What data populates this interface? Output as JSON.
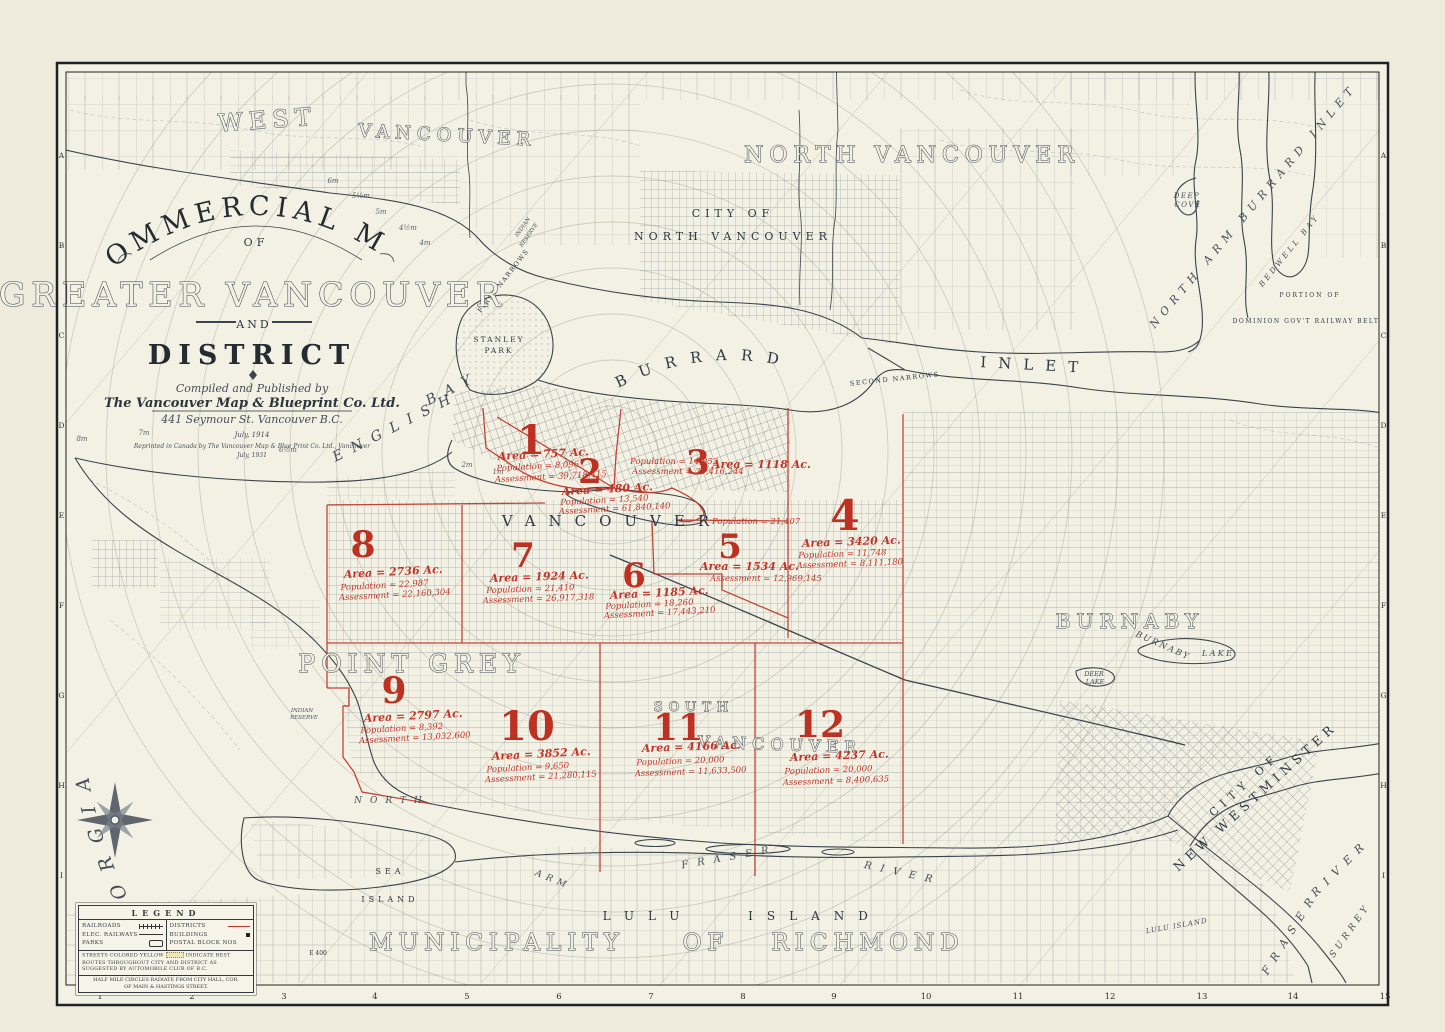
{
  "page": {
    "year": "Year 1913"
  },
  "cartouche": {
    "arc": "COMMERCIAL MAP",
    "of": "OF",
    "main": "GREATER VANCOUVER",
    "and": "AND",
    "district": "DISTRICT",
    "compiled": "Compiled and Published by",
    "publisher": "The Vancouver Map & Blueprint Co. Ltd.",
    "address": "441 Seymour St. Vancouver B.C.",
    "date": "July, 1914",
    "reprint": "Reprinted in Canada by The Vancouver Map & Blue Print Co. Ltd., Vancouver",
    "date2": "July, 1931"
  },
  "labels": {
    "west": "WEST",
    "west_van": "VANCOUVER",
    "north_vancouver": "NORTH  VANCOUVER",
    "city_of": "CITY OF",
    "city_of_nv": "NORTH VANCOUVER",
    "burrard": "BURRARD",
    "inlet": "INLET",
    "first_narrows": "FIRST NARROWS",
    "second_narrows": "SECOND NARROWS",
    "stanley": "STANLEY",
    "park": "PARK",
    "english": "ENGLISH",
    "bay": "BAY",
    "vancouver": "VANCOUVER",
    "point_grey": "POINT GREY",
    "south": "SOUTH",
    "south_van": "VANCOUVER",
    "burnaby": "BURNABY",
    "burnaby_lk1": "BURNABY",
    "burnaby_lk2": "LAKE",
    "deer1": "DEER",
    "deer2": "LAKE",
    "gulf": "GULF OF GEORGIA",
    "north": "NORTH",
    "arm": "ARM",
    "fraser_n": "FRASER",
    "river_n": "RIVER",
    "sea": "SEA",
    "island_s": "ISLAND",
    "lulu": "LULU",
    "island_l": "ISLAND",
    "municipality": "MUNICIPALITY",
    "of": "OF",
    "richmond": "RICHMOND",
    "city_of2": "CITY OF",
    "new_west": "NEW WESTMINSTER",
    "fraser_m": "FRASER",
    "river_m": "RIVER",
    "surrey": "SURREY",
    "nabi": "NORTH ARM BURRARD INLET",
    "deep": "DEEP",
    "cove": "COVE",
    "bedwell": "BEDWELL BAY",
    "portion": "PORTION OF",
    "dominion": "DOMINION GOV'T RAILWAY BELT",
    "lulu_small": "LULU ISLAND",
    "indian1": "INDIAN",
    "reserve1": "RESERVE",
    "e400": "E 400"
  },
  "depths": [
    "6m",
    "5½m",
    "5m",
    "4½m",
    "4m",
    "8m",
    "7m",
    "6½m",
    "2m",
    "1m"
  ],
  "districts": [
    {
      "no": "1",
      "area": "Area = 757 Ac.",
      "pop": "Population = 8,096",
      "asm": "Assessment = 39,718,415"
    },
    {
      "no": "2",
      "area": "Area = 480 Ac.",
      "pop": "Population = 13,540",
      "asm": "Assessment = 61,840,140"
    },
    {
      "no": "3",
      "area": "Area = 1118 Ac.",
      "pop": "Population = 14,853",
      "asm": "Assessment = 39,416,244"
    },
    {
      "no": "4",
      "area": "Area = 3420 Ac.",
      "pop": "Population = 11,748",
      "asm": "Assessment = 8,111,180"
    },
    {
      "no": "5",
      "area": "Area = 1534 Ac.",
      "pop": "Population = 21,407",
      "asm": "Assessment = 12,969,145"
    },
    {
      "no": "6",
      "area": "Area = 1185 Ac.",
      "pop": "Population = 18,260",
      "asm": "Assessment = 17,443,210"
    },
    {
      "no": "7",
      "area": "Area = 1924 Ac.",
      "pop": "Population = 21,410",
      "asm": "Assessment = 26,917,318"
    },
    {
      "no": "8",
      "area": "Area = 2736 Ac.",
      "pop": "Population = 22,987",
      "asm": "Assessment = 22,160,304"
    },
    {
      "no": "9",
      "area": "Area = 2797 Ac.",
      "pop": "Population = 8,392",
      "asm": "Assessment = 13,032,600"
    },
    {
      "no": "10",
      "area": "Area = 3852 Ac.",
      "pop": "Population = 9,650",
      "asm": "Assessment = 21,280,115"
    },
    {
      "no": "11",
      "area": "Area = 4166 Ac.",
      "pop": "Population = 20,000",
      "asm": "Assessment = 11,633,500"
    },
    {
      "no": "12",
      "area": "Area = 4237 Ac.",
      "pop": "Population = 20,000",
      "asm": "Assessment = 8,400,635"
    }
  ],
  "legend": {
    "title": "LEGEND",
    "left": [
      "RAILROADS",
      "ELEC. RAILWAYS",
      "PARKS"
    ],
    "right": [
      "DISTRICTS",
      "BUILDINGS",
      "POSTAL BLOCK NOS"
    ],
    "note1a": "STREETS COLORED YELLOW",
    "note1b": "INDICATE BEST ROUTES THROUGHOUT CITY AND DISTRICT AS SUGGESTED BY AUTOMOBILE CLUB OF B.C.",
    "note2": "HALF MILE CIRCLES RADIATE FROM CITY HALL, COR. OF MAIN & HASTINGS STREET."
  },
  "border": {
    "letters": [
      "A",
      "B",
      "C",
      "D",
      "E",
      "F",
      "G",
      "H",
      "I"
    ],
    "numbers": [
      "1",
      "2",
      "3",
      "4",
      "5",
      "6",
      "7",
      "8",
      "9",
      "10",
      "11",
      "12",
      "13",
      "14",
      "15"
    ]
  },
  "colors": {
    "ink": "#323d47",
    "red": "#c0372a",
    "paper": "#f3f1e4"
  }
}
